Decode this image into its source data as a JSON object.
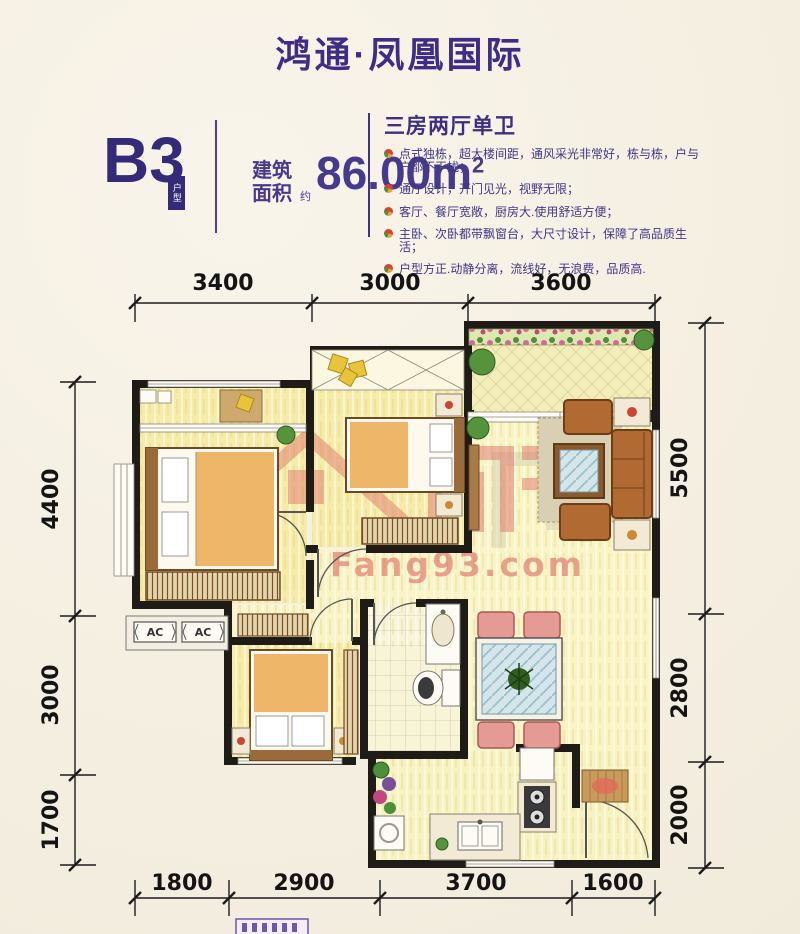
{
  "header": {
    "title": "鸿通·凤凰国际"
  },
  "unit": {
    "code": "B3",
    "badge": "户型",
    "area_label_1": "建筑",
    "area_label_2": "面积",
    "approx": "约",
    "area_value": "86.00m",
    "area_sup": "2"
  },
  "features": {
    "heading": "三房两厅单卫",
    "bullets": [
      "点式独栋，超大楼间距，通风采光非常好，栋与栋，户与户都不干扰；",
      "通厅设计，开门见光，视野无限；",
      "客厅、餐厅宽敞，厨房大.使用舒适方便；",
      "主卧、次卧都带飘窗台，大尺寸设计，保障了高品质生活；",
      "户型方正.动静分离，流线好，无浪费，品质高."
    ]
  },
  "plan": {
    "dim_top": [
      "3400",
      "3000",
      "3600"
    ],
    "dim_bottom": [
      "1800",
      "2900",
      "3700",
      "1600"
    ],
    "dim_left": [
      "4400",
      "3000",
      "1700"
    ],
    "dim_right": [
      "5500",
      "2800",
      "2000"
    ],
    "ac": [
      "AC",
      "AC"
    ],
    "watermark": "Fang93.com",
    "colors": {
      "accent_purple": "#3e2d86",
      "text_purple": "#3f3786",
      "wall_black": "#1f1b16",
      "floor_yellow": "#f7efb4",
      "watermark_red": "#e0766a"
    }
  }
}
